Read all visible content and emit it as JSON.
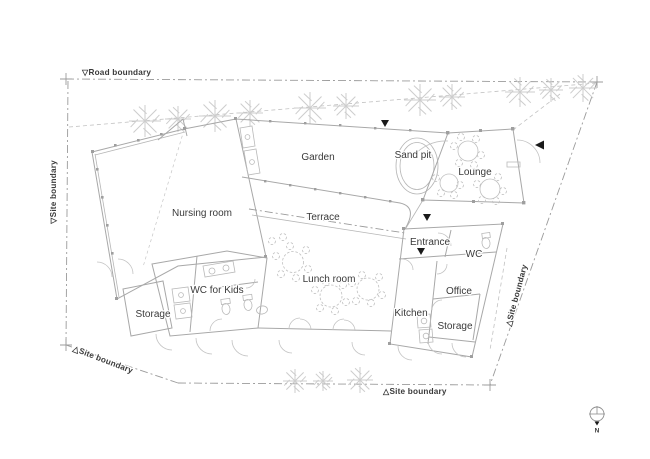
{
  "title": "Nursery building site plan",
  "boundaries": {
    "road": "▽Road boundary",
    "site_left": "▽Site boundary",
    "site_bottom_left": "△Site boundary",
    "site_bottom": "△Site boundary",
    "site_right": "△Site boundary"
  },
  "rooms": {
    "nursing_room": "Nursing room",
    "garden": "Garden",
    "sand_pit": "Sand pit",
    "lounge": "Lounge",
    "terrace": "Terrace",
    "lunch_room": "Lunch room",
    "entrance": "Entrance",
    "wc": "WC",
    "office": "Office",
    "kitchen": "Kitchen",
    "storage_east": "Storage",
    "wc_for_kids": "WC for Kids",
    "storage_west": "Storage"
  },
  "compass": {
    "north": "N"
  },
  "colors": {
    "background": "#ffffff",
    "wall_line": "#a8a8a8",
    "boundary_line": "#9b9b9b",
    "tree_line": "#cdcdcd",
    "text": "#3a3a3a",
    "marker": "#1a1a1a"
  }
}
